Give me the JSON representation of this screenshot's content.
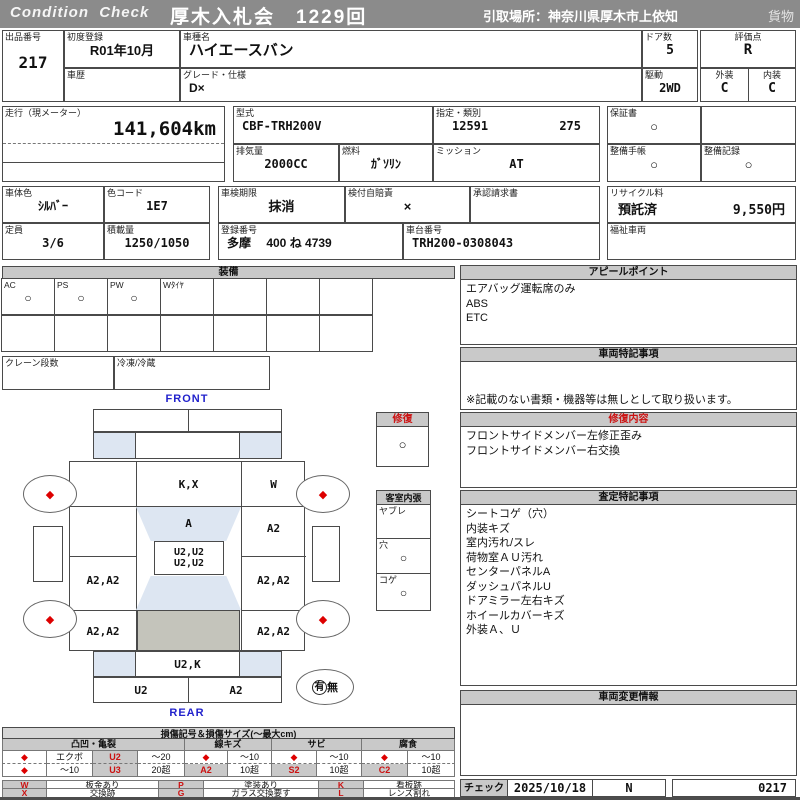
{
  "header": {
    "brand": "Condition  Check",
    "auction": "厚木入札会　1229回",
    "pickup": "引取場所：神奈川県厚木市上依知",
    "category": "貨物"
  },
  "info": {
    "lot_label": "出品番号",
    "lot_value": "217",
    "first_reg_label": "初度登録",
    "first_reg_value": "R01年10月",
    "history_label": "車歴",
    "history_value": "",
    "model_name_label": "車種名",
    "model_name_value": "ハイエースバン",
    "grade_label": "グレード・仕様",
    "grade_value": "D×",
    "doors_label": "ドア数",
    "doors_value": "5",
    "drive_label": "駆動",
    "drive_value": "2WD",
    "score_label": "評価点",
    "score_value": "R",
    "exterior_label": "外装",
    "exterior_value": "C",
    "interior_label": "内装",
    "interior_value": "C",
    "mileage_label": "走行（現メーター）",
    "mileage_value": "141,604km",
    "model_code_label": "型式",
    "model_code_value": "CBF-TRH200V",
    "type_label": "指定・類別",
    "type_value1": "12591",
    "type_value2": "275",
    "displacement_label": "排気量",
    "displacement_value": "2000CC",
    "fuel_label": "燃料",
    "fuel_value": "ｶﾞｿﾘﾝ",
    "mission_label": "ミッション",
    "mission_value": "AT",
    "warranty_label": "保証書",
    "warranty_value": "○",
    "book_label": "整備手帳",
    "book_value": "○",
    "record_label": "整備記録",
    "record_value": "○",
    "color_label": "車体色",
    "color_value": "ｼﾙﾊﾞｰ",
    "color_code_label": "色コード",
    "color_code_value": "1E7",
    "capacity_label": "定員",
    "capacity_value": "3/6",
    "load_label": "積載量",
    "load_value": "1250/1050",
    "inspection_label": "車検期限",
    "inspection_value": "抹消",
    "insurance_label": "検付自賠責",
    "insurance_value": "×",
    "approval_label": "承認請求書",
    "approval_value": "",
    "reg_number_label": "登録番号",
    "reg_number_value": "多摩　 400 ね 4739",
    "chassis_label": "車台番号",
    "chassis_value": "TRH200-0308043",
    "recycle_label": "リサイクル料",
    "recycle_status": "預託済",
    "recycle_fee": "9,550円",
    "welfare_label": "福祉車両",
    "welfare_value": ""
  },
  "equipment": {
    "title": "装備",
    "items": [
      {
        "label": "AC",
        "value": "○"
      },
      {
        "label": "PS",
        "value": "○"
      },
      {
        "label": "PW",
        "value": "○"
      },
      {
        "label": "Wﾀｲﾔ",
        "value": ""
      },
      {
        "label": "",
        "value": ""
      },
      {
        "label": "",
        "value": ""
      },
      {
        "label": "",
        "value": ""
      }
    ],
    "crane_label": "クレーン段数",
    "crane_value": "",
    "freezer_label": "冷凍/冷蔵",
    "freezer_value": ""
  },
  "diagram": {
    "front_label": "FRONT",
    "rear_label": "REAR",
    "wheel_mark": "◆",
    "cells": {
      "hood": "K,X",
      "hood_right": "W",
      "windshield": "A",
      "front_right": "A2",
      "roof1": "U2,U2",
      "roof2": "U2,U2",
      "mid_left": "A2,A2",
      "mid_right": "A2,A2",
      "low_left": "A2,A2",
      "low_right": "A2,A2",
      "rear_glass": "U2,K",
      "bumper_left": "U2",
      "bumper_right": "A2"
    },
    "repair": {
      "title": "修復",
      "value": "○"
    },
    "cabin": {
      "title": "客室内張",
      "rows": [
        {
          "label": "ヤブレ",
          "value": ""
        },
        {
          "label": "穴",
          "value": "○"
        },
        {
          "label": "コゲ",
          "value": "○"
        }
      ]
    },
    "spare": {
      "yes": "有",
      "no": "無"
    }
  },
  "sections": {
    "appeal": {
      "title": "アピールポイント",
      "lines": [
        "エアバッグ運転席のみ",
        "ABS",
        "ETC"
      ]
    },
    "special": {
      "title": "車両特記事項",
      "note": "※記載のない書類・機器等は無しとして取り扱います。"
    },
    "repair_detail": {
      "title": "修復内容",
      "lines": [
        "フロントサイドメンバー左修正歪み",
        "フロントサイドメンバー右交換"
      ]
    },
    "assessment": {
      "title": "査定特記事項",
      "lines": [
        "シートコゲ（穴）",
        "内装キズ",
        "室内汚れ/スレ",
        "荷物室ＡＵ汚れ",
        "センターパネルA",
        "ダッシュパネルU",
        "ドアミラー左右キズ",
        "ホイールカバーキズ",
        "外装Ａ、Ｕ"
      ]
    },
    "change_info": {
      "title": "車両変更情報"
    },
    "check": {
      "label": "チェック",
      "date": "2025/10/18",
      "inspector": "N",
      "number": "0217"
    }
  },
  "legend": {
    "title": "損傷記号＆損傷サイズ(〜最大cm)",
    "group_names": [
      "凸凹・亀裂",
      "線キズ",
      "サビ",
      "腐食"
    ],
    "row1": [
      "◆",
      "エクボ",
      "U2",
      "〜20",
      "◆",
      "〜10",
      "◆",
      "〜10",
      "◆",
      "〜10"
    ],
    "row2": [
      "◆",
      "〜10",
      "U3",
      "20超",
      "A2",
      "10超",
      "S2",
      "10超",
      "C2",
      "10超"
    ],
    "symbols": [
      {
        "code": "W",
        "desc": "板金あり"
      },
      {
        "code": "P",
        "desc": "塗装あり"
      },
      {
        "code": "K",
        "desc": "看板跡"
      },
      {
        "code": "X",
        "desc": "交換跡"
      },
      {
        "code": "G",
        "desc": "ガラス交換要す"
      },
      {
        "code": "L",
        "desc": "レンズ割れ"
      }
    ]
  }
}
